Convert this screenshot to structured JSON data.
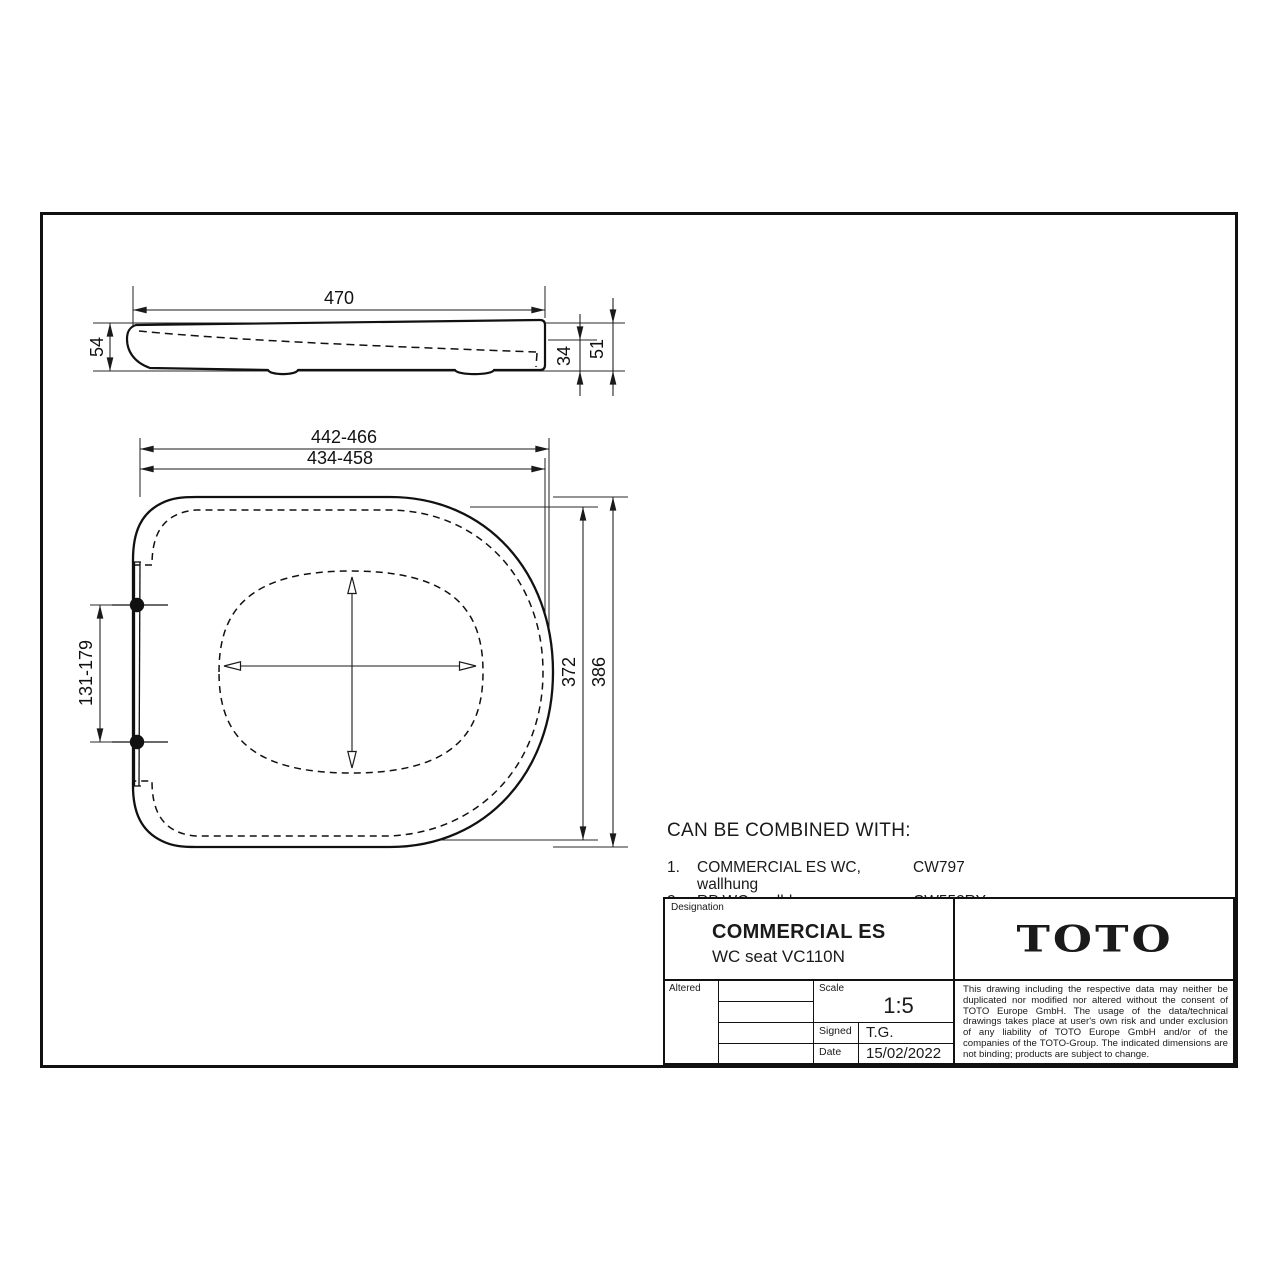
{
  "side_view": {
    "dims": {
      "length": "470",
      "height": "54",
      "h_seat": "34",
      "h_total": "51"
    }
  },
  "top_view": {
    "dims": {
      "width_outer": "442-466",
      "width_inner": "434-458",
      "hinge_spacing": "131-179",
      "depth_seat": "372",
      "depth_lid": "386"
    }
  },
  "combine": {
    "heading": "CAN BE COMBINED WITH:",
    "items": [
      {
        "num": "1.",
        "name": "COMMERCIAL ES WC, wallhung",
        "code": "CW797"
      },
      {
        "num": "2.",
        "name": "RP WC, wall-hung",
        "code": "CW552RY"
      }
    ]
  },
  "title_block": {
    "designation_label": "Designation",
    "title": "COMMERCIAL ES",
    "subtitle": "WC seat VC110N",
    "logo": "TOTO",
    "altered_label": "Altered",
    "scale_label": "Scale",
    "scale_value": "1:5",
    "signed_label": "Signed",
    "signed_value": "T.G.",
    "date_label": "Date",
    "date_value": "15/02/2022",
    "disclaimer": "This drawing including the respective data may neither be duplicated nor modified nor altered without the consent of TOTO Europe GmbH. The usage of the data/technical drawings takes place at user's own risk and under exclusion of any liability of TOTO Europe GmbH and/or of the companies of the TOTO-Group. The indicated dimensions are not binding; products are subject to change."
  }
}
